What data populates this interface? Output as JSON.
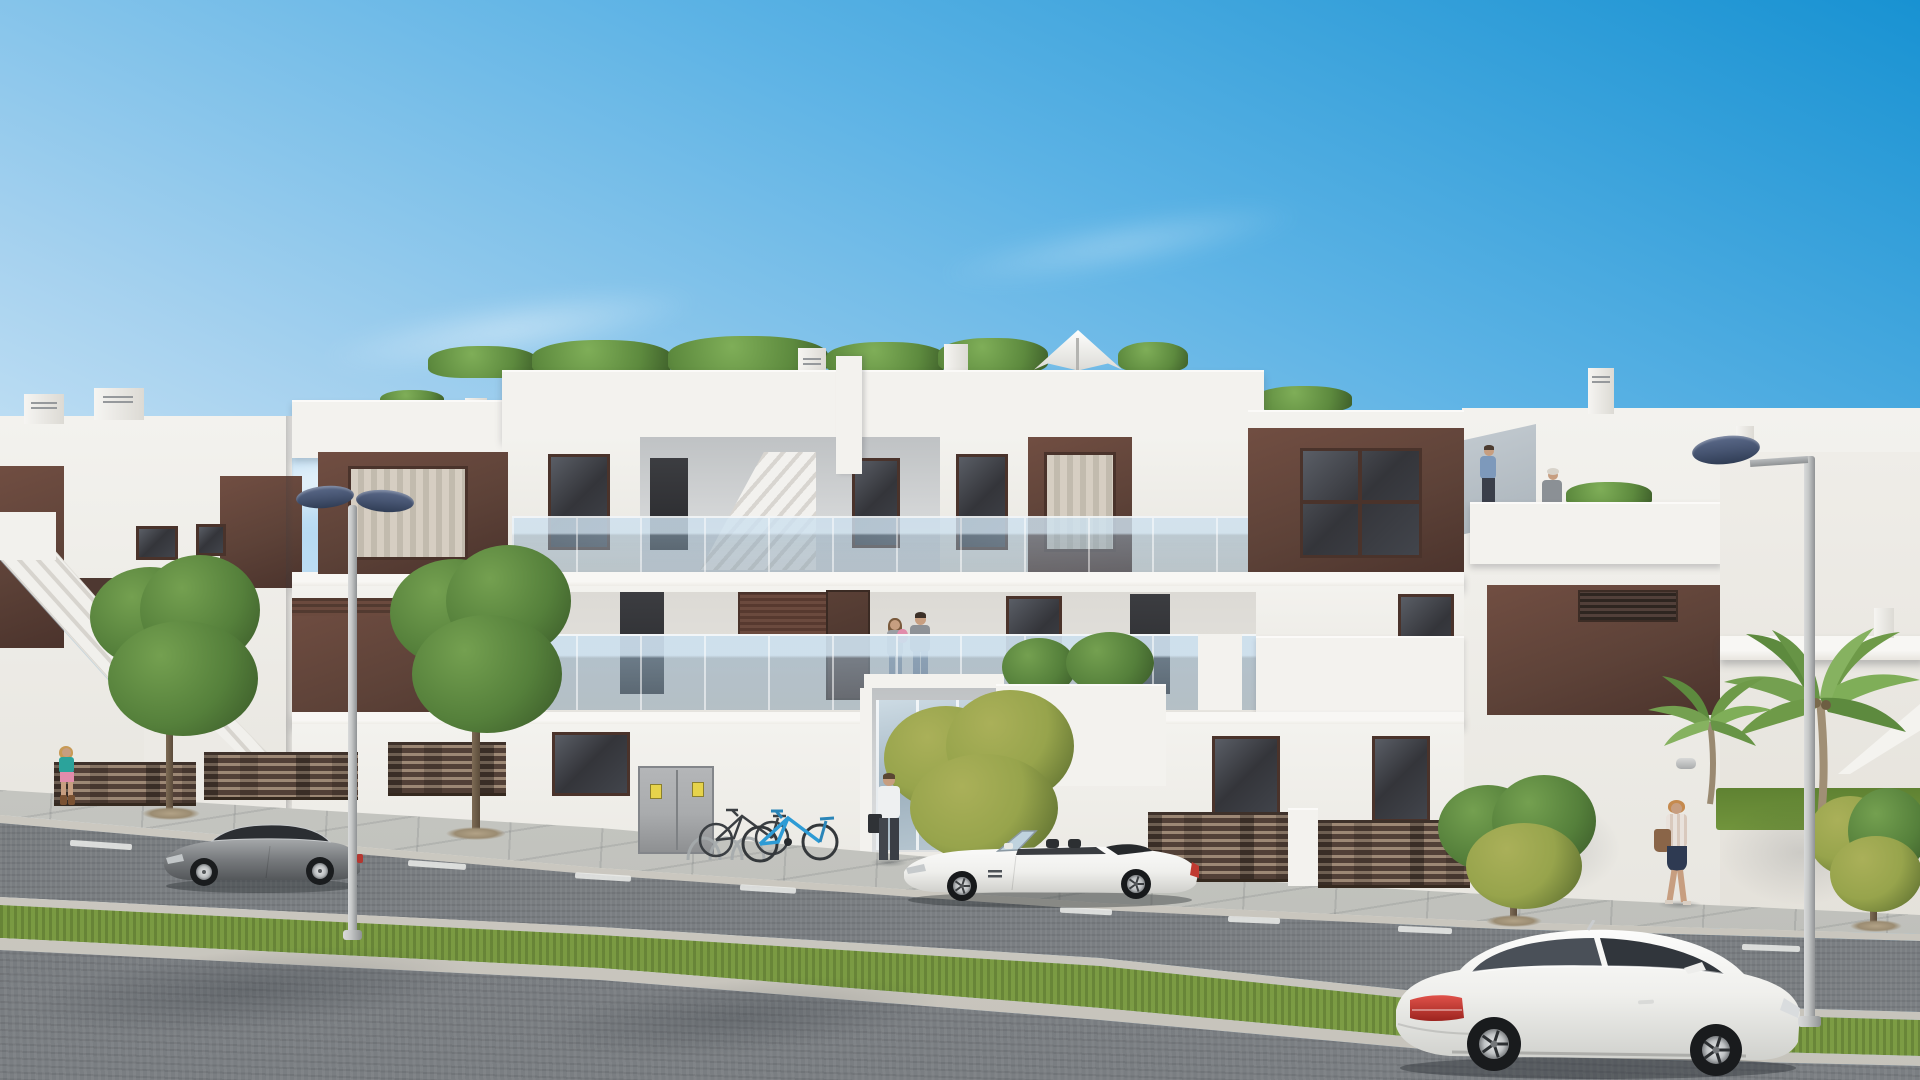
{
  "scene": {
    "title": "New-build apartment complex — street view architectural render",
    "type": "architectural-render",
    "aria_label": "Photorealistic render of a modern white three-storey apartment building with brown accent panels, rooftop terraces with plants and a white parasol, glass balconies, a street with a grass median, two street lamps, parked cars, bicycles and pedestrians under a clear blue sky"
  },
  "palette": {
    "sky-top": "#1892d2",
    "sky-mid": "#5db3e5",
    "sky-low": "#a7d2ef",
    "sky-horizon": "#dfeffa",
    "wall": "#f3f2ee",
    "wall2": "#e8e6e0",
    "wallshade": "#d8d5cf",
    "recess": "#d3d5d6",
    "recess2": "#bfc2c4",
    "brown": "#5d4238",
    "brown2": "#4b332c",
    "brown3": "#714e42",
    "frame": "#4a332b",
    "win": "#34353a",
    "curtain": "#d6cec2",
    "rail": "#f2f6f8",
    "glassblue": "#a9c2d4",
    "plant": "#55803b",
    "plant2": "#74a050",
    "plantdark": "#3c5c2a",
    "yellowleaf": "#97a44c",
    "palm": "#79a251",
    "grass": "#6f9039",
    "grass2": "#57762c",
    "side": "#c9cac5",
    "curb": "#dbd9d2",
    "curb2": "#c6c3bb",
    "road": "#7c8084",
    "road2": "#6d7174",
    "roadfront": "#717579",
    "dash": "#ecedeb",
    "fence": "#524037",
    "slat": "#9d8875",
    "cab": "#a9abad",
    "sticker": "#e6d34b",
    "pole": "#c6c8c8",
    "pole2": "#8f9294",
    "lamp": "#475572",
    "lamp2": "#303d55",
    "car-grey": "#787b7e",
    "car-white": "#f3f3f1",
    "tint": "#3a3f45",
    "taillight-red": "#c03a31",
    "bike-blue": "#2d9bd5",
    "skin": "#c79e80"
  },
  "inventory": {
    "buildings": [
      {
        "name": "left-apartment-block",
        "features": "external staircase, brown accent walls, roof chimneys"
      },
      {
        "name": "main-apartment-block",
        "features": "roof terrace with plants and white parasol, glass balconies, brown panels, glazed entrance, utility cabinet, bike rack"
      },
      {
        "name": "right-apartment-block",
        "features": "roof terrace with two people, large brown panel, palm trees, garden lawn"
      }
    ],
    "vehicles": [
      {
        "name": "grey-sports-coupe",
        "color_key": "car-grey",
        "position": "parked left on near road"
      },
      {
        "name": "white-convertible-roadster",
        "color_key": "car-white",
        "position": "parked centre in front of entrance"
      },
      {
        "name": "white-coupe-foreground",
        "color_key": "car-white",
        "position": "foreground road bottom right"
      }
    ],
    "people": [
      "couple-with-baby-on-first-floor-balcony",
      "man-with-briefcase-at-entrance",
      "woman-at-left-gate",
      "woman-walking-on-right-sidewalk",
      "man-on-right-roof-terrace",
      "woman-on-right-roof-terrace"
    ],
    "street": {
      "lamps": 2,
      "roads": 2,
      "median": "grass strip with concrete curbs",
      "bicycles": 2,
      "lane_marking": "white dashed line"
    }
  }
}
